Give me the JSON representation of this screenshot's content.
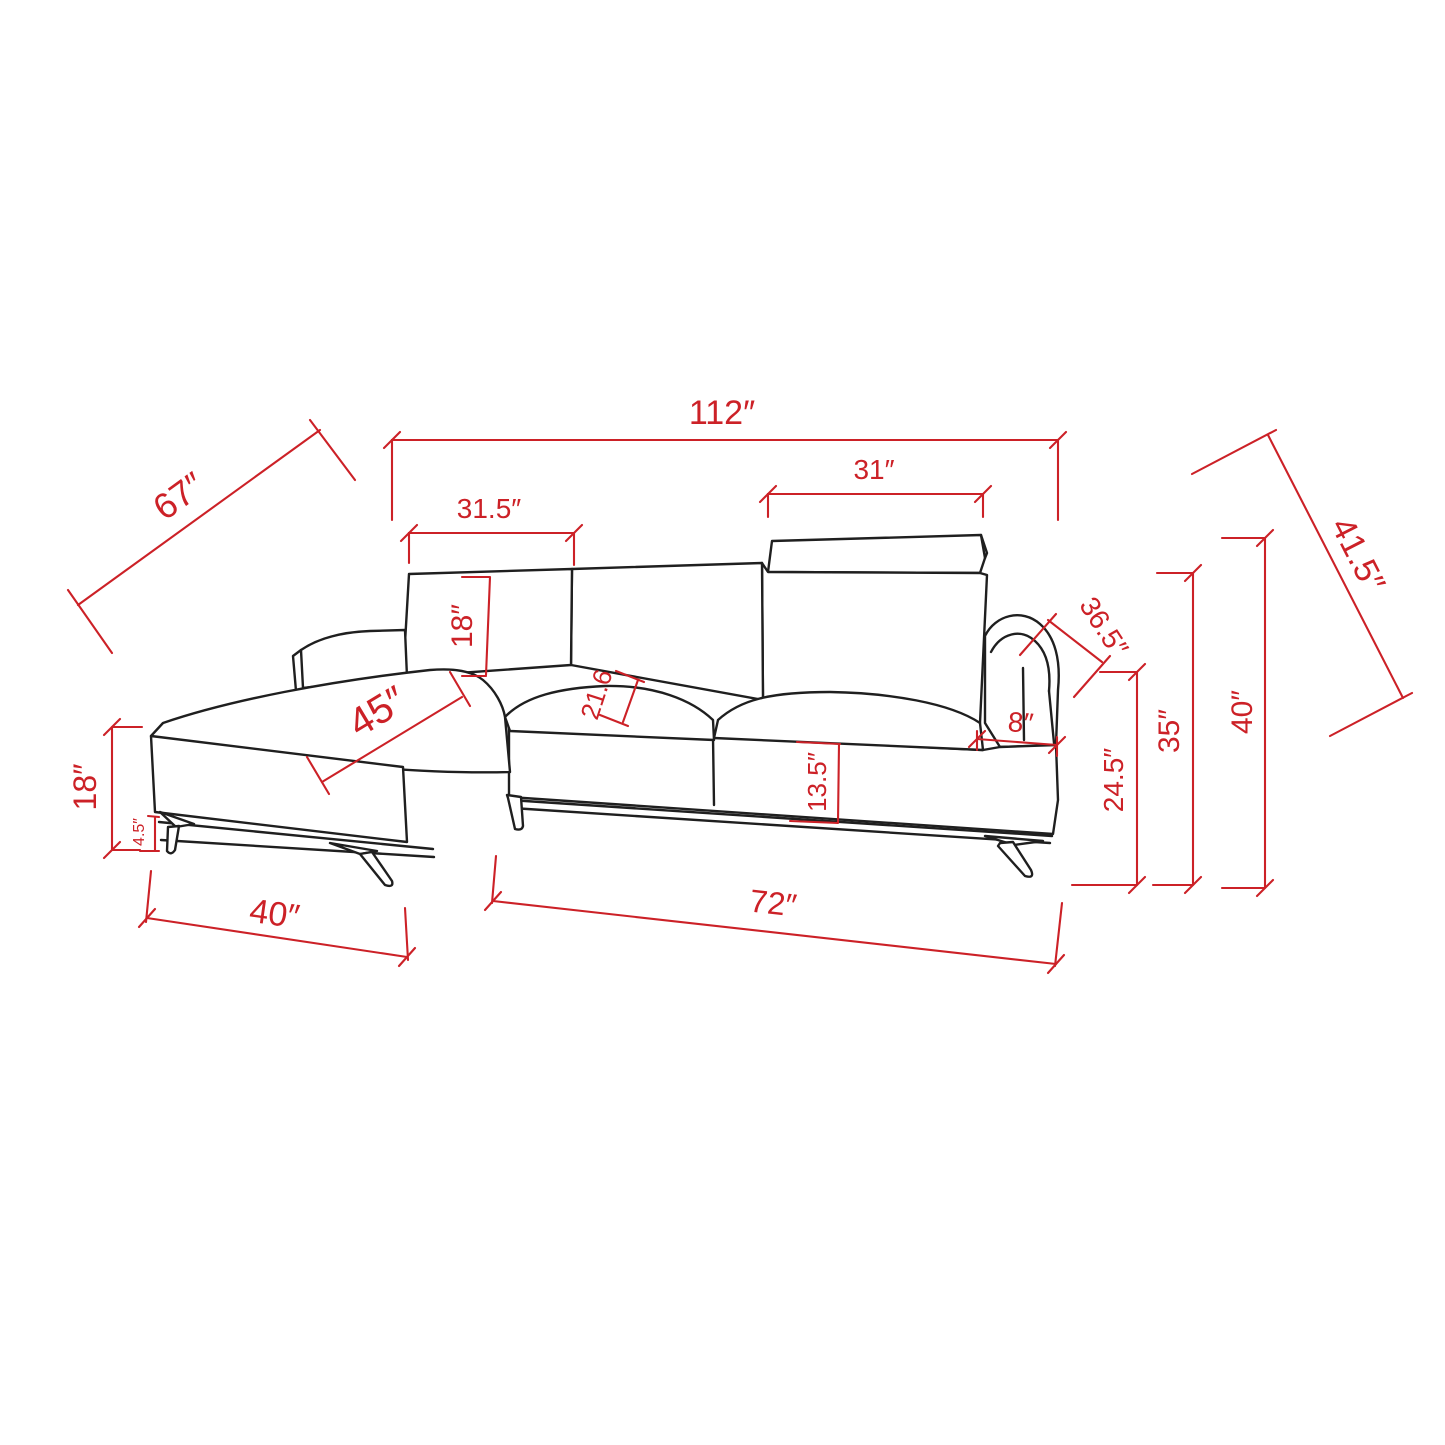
{
  "drawing": {
    "type": "furniture-dimension-diagram",
    "subject": "sectional sofa with left chaise, headrest and metal legs",
    "unit": "inches",
    "background": "#ffffff",
    "outline_color": "#1f1f1f",
    "dimension_color": "#cc2127"
  },
  "dimensions": {
    "overall_width": {
      "label": "112″",
      "value": 112
    },
    "chaise_outer_diagonal": {
      "label": "67″",
      "value": 67
    },
    "left_back_cushion_width": {
      "label": "31.5″",
      "value": 31.5
    },
    "headrest_width": {
      "label": "31″",
      "value": 31
    },
    "right_outer_diagonal": {
      "label": "41.5″",
      "value": 41.5
    },
    "back_cushion_height": {
      "label": "18″",
      "value": 18
    },
    "chaise_cushion_length": {
      "label": "45″",
      "value": 45
    },
    "seat_depth": {
      "label": "21.6",
      "value": 21.6
    },
    "arm_diagonal": {
      "label": "36.5″",
      "value": 36.5
    },
    "arm_width": {
      "label": "8″",
      "value": 8
    },
    "base_front_height": {
      "label": "13.5″",
      "value": 13.5
    },
    "arm_height": {
      "label": "24.5″",
      "value": 24.5
    },
    "back_height": {
      "label": "35″",
      "value": 35
    },
    "overall_height": {
      "label": "40″",
      "value": 40
    },
    "chaise_seat_height": {
      "label": "18″",
      "value": 18
    },
    "leg_height": {
      "label": "4.5″",
      "value": 4.5
    },
    "chaise_width": {
      "label": "40″",
      "value": 40
    },
    "sofa_length": {
      "label": "72″",
      "value": 72
    }
  }
}
